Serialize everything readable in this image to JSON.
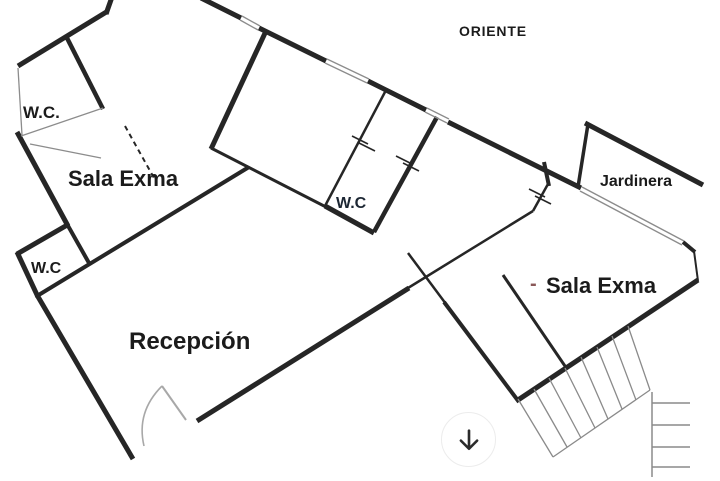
{
  "labels": {
    "oriente": {
      "text": "ORIENTE",
      "x": 459,
      "y": 24,
      "size": 14,
      "spacing": 0.8,
      "color": "text"
    },
    "wc_top_left": {
      "text": "W.C.",
      "x": 23,
      "y": 104,
      "size": 17,
      "spacing": 0,
      "color": "text"
    },
    "sala_exma_left": {
      "text": "Sala Exma",
      "x": 68,
      "y": 168,
      "size": 22,
      "spacing": 0,
      "color": "text"
    },
    "jardinera": {
      "text": "Jardinera",
      "x": 600,
      "y": 174,
      "size": 16,
      "spacing": 0,
      "color": "text"
    },
    "wc_center": {
      "text": "W.C",
      "x": 336,
      "y": 196,
      "size": 16,
      "spacing": 0,
      "color": "text_navy"
    },
    "wc_lower_left": {
      "text": "W.C",
      "x": 31,
      "y": 261,
      "size": 16,
      "spacing": 0,
      "color": "text"
    },
    "red_dash": {
      "text": "-",
      "x": 530,
      "y": 274,
      "size": 20,
      "spacing": 0,
      "color": "accent_red"
    },
    "sala_exma_right": {
      "text": "Sala Exma",
      "x": 546,
      "y": 275,
      "size": 22,
      "spacing": 0,
      "color": "text"
    },
    "recepcion": {
      "text": "Recepción",
      "x": 129,
      "y": 330,
      "size": 24,
      "spacing": 0,
      "color": "text"
    }
  },
  "scroll_button": {
    "icon": "down-arrow",
    "x": 441,
    "y": 412,
    "diameter": 55
  },
  "colors": {
    "wall": "#262626",
    "thin": "#8c8c8c",
    "stairs": "#8a8a8a",
    "door": "#a8a8a8",
    "text": "#1b1b1b",
    "text_navy": "#1c2633",
    "accent_red": "#8a5858",
    "arrow": "#2b2b2b",
    "button_border": "#ececec"
  },
  "geometry": {
    "lines": [
      [
        112,
        -3,
        106,
        14,
        5,
        "wall"
      ],
      [
        108,
        11,
        18,
        66,
        5,
        "wall"
      ],
      [
        66,
        36,
        103,
        109,
        4.5,
        "wall"
      ],
      [
        17,
        132,
        68,
        226,
        5,
        "wall"
      ],
      [
        69,
        224,
        17,
        254,
        5,
        "wall"
      ],
      [
        17,
        252,
        38,
        297,
        5,
        "wall"
      ],
      [
        37,
        295,
        133,
        459,
        5,
        "wall"
      ],
      [
        67,
        224,
        89,
        263,
        4,
        "wall"
      ],
      [
        37,
        296,
        249,
        167,
        4,
        "wall"
      ],
      [
        266,
        31,
        211,
        149,
        5,
        "wall"
      ],
      [
        211,
        148,
        326,
        207,
        3,
        "wall"
      ],
      [
        325,
        206,
        374,
        233,
        5,
        "wall"
      ],
      [
        201,
        -2,
        241,
        18,
        5,
        "wall"
      ],
      [
        259,
        28,
        326,
        61,
        5,
        "wall"
      ],
      [
        368,
        81,
        426,
        110,
        5,
        "wall"
      ],
      [
        448,
        122,
        581,
        188,
        5,
        "wall"
      ],
      [
        437,
        117,
        374,
        232,
        4.5,
        "wall"
      ],
      [
        544,
        162,
        549,
        186,
        4,
        "wall"
      ],
      [
        585,
        123,
        703,
        185,
        5,
        "wall"
      ],
      [
        588,
        124,
        578,
        187,
        3.5,
        "wall"
      ],
      [
        683,
        242,
        695,
        252,
        4,
        "wall"
      ],
      [
        518,
        400,
        698,
        280,
        5,
        "wall"
      ],
      [
        197,
        421,
        409,
        288,
        5,
        "wall"
      ],
      [
        444,
        302,
        519,
        402,
        4,
        "wall"
      ],
      [
        385,
        92,
        325,
        206,
        2.5,
        "wall"
      ],
      [
        548,
        184,
        533,
        211,
        2.5,
        "wall"
      ],
      [
        533,
        211,
        408,
        288,
        2.5,
        "wall"
      ],
      [
        408,
        253,
        446,
        304,
        2.5,
        "wall"
      ],
      [
        503,
        275,
        567,
        369,
        3,
        "wall"
      ],
      [
        694,
        251,
        698,
        281,
        2,
        "wall"
      ],
      [
        352,
        136,
        368,
        144,
        1.6,
        "wall"
      ],
      [
        359,
        143,
        375,
        151,
        1.6,
        "wall"
      ],
      [
        396,
        156,
        412,
        164,
        1.6,
        "wall"
      ],
      [
        403,
        163,
        419,
        171,
        1.6,
        "wall"
      ],
      [
        529,
        189,
        545,
        197,
        1.6,
        "wall"
      ],
      [
        535,
        196,
        551,
        204,
        1.6,
        "wall"
      ],
      [
        103,
        108,
        21,
        136,
        1.3,
        "thin"
      ],
      [
        18,
        68,
        22,
        135,
        1.3,
        "thin"
      ],
      [
        30,
        144,
        101,
        158,
        1.2,
        "thin"
      ],
      [
        240,
        20,
        258,
        30,
        1.3,
        "thin"
      ],
      [
        242,
        16,
        260,
        26,
        1.3,
        "thin"
      ],
      [
        325,
        63,
        367,
        83,
        1.3,
        "thin"
      ],
      [
        327,
        59,
        369,
        79,
        1.3,
        "thin"
      ],
      [
        425,
        112,
        447,
        123,
        1.3,
        "thin"
      ],
      [
        427,
        108,
        449,
        119,
        1.3,
        "thin"
      ],
      [
        580,
        191,
        682,
        245,
        1.4,
        "thin"
      ],
      [
        582,
        187,
        684,
        241,
        1.4,
        "thin"
      ],
      [
        518,
        399,
        553,
        457,
        1.3,
        "stairs"
      ],
      [
        553,
        457,
        650,
        390,
        1.3,
        "stairs"
      ],
      [
        650,
        390,
        628,
        326,
        1.3,
        "stairs"
      ],
      [
        534,
        389,
        567,
        447,
        1.3,
        "stairs"
      ],
      [
        549,
        378,
        581,
        438,
        1.3,
        "stairs"
      ],
      [
        565,
        368,
        595,
        428,
        1.3,
        "stairs"
      ],
      [
        581,
        357,
        608,
        419,
        1.3,
        "stairs"
      ],
      [
        597,
        347,
        622,
        409,
        1.3,
        "stairs"
      ],
      [
        612,
        336,
        636,
        400,
        1.3,
        "stairs"
      ],
      [
        652,
        392,
        652,
        477,
        1.5,
        "stairs"
      ],
      [
        652,
        403,
        690,
        403,
        1.5,
        "stairs"
      ],
      [
        652,
        425,
        690,
        425,
        1.5,
        "stairs"
      ],
      [
        652,
        447,
        690,
        447,
        1.5,
        "stairs"
      ],
      [
        652,
        467,
        690,
        467,
        1.5,
        "stairs"
      ]
    ],
    "paths": [
      {
        "d": "M125 126 L154 178",
        "w": 2,
        "c": "wall",
        "dash": "5,4",
        "name": "dashed-door-line"
      },
      {
        "d": "M162 386 L186 420",
        "w": 2,
        "c": "door",
        "dash": "",
        "name": "door-leaf"
      },
      {
        "d": "M162 386 Q136 412 144 446",
        "w": 1.6,
        "c": "door",
        "dash": "",
        "name": "door-swing-arc"
      }
    ]
  }
}
